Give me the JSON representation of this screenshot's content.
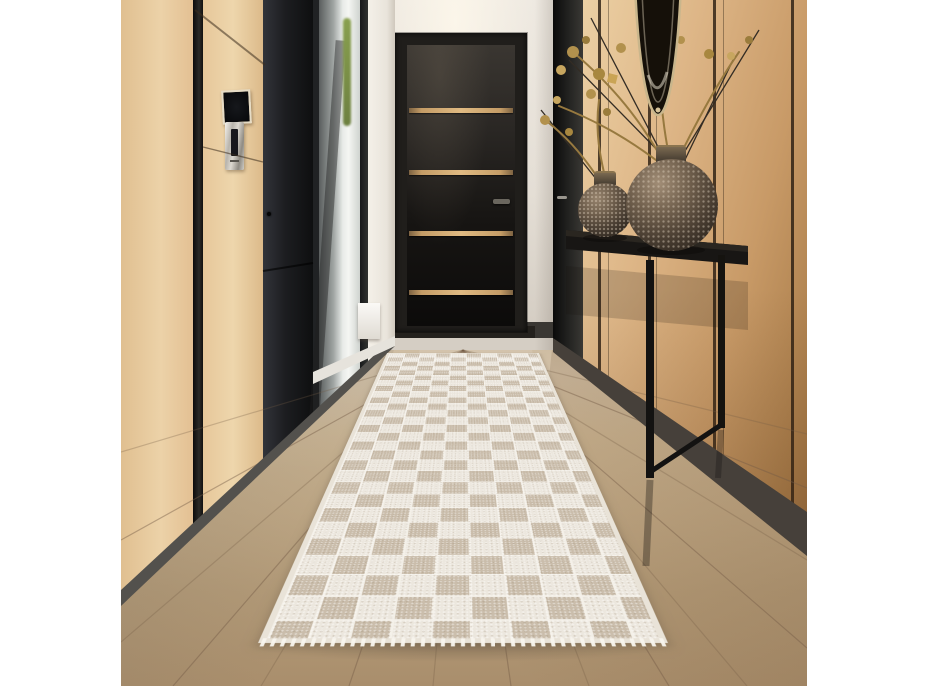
{
  "scene": {
    "type": "interior-photograph",
    "description": "Modern hallway interior: light oak wall paneling with black reveals, a black interior door with four gold inlay stripes, a glass side door, a slim black console table holding two hammered bronze sphere vases with dried gold botanicals beneath a black oval mirror, and an ivory checkerboard runner rug on a glossy light oak floor.",
    "objects": [
      {
        "label": "oak wall paneling"
      },
      {
        "label": "black interior door with gold inlay stripes"
      },
      {
        "label": "glass side door"
      },
      {
        "label": "wall-mounted access screen"
      },
      {
        "label": "metal restroom sign"
      },
      {
        "label": "black console table"
      },
      {
        "label": "hammered bronze sphere vase (small)"
      },
      {
        "label": "hammered bronze sphere vase (large)"
      },
      {
        "label": "dried gold floral arrangement"
      },
      {
        "label": "oval black-framed mirror"
      },
      {
        "label": "ivory checkerboard runner rug"
      },
      {
        "label": "glossy oak plank floor"
      }
    ],
    "rug": {
      "pattern": "checkerboard",
      "columns": 10,
      "rows": 28
    }
  },
  "colors": {
    "wood_light": "#ecd2a8",
    "wood_mid": "#ddb586",
    "wood_dark": "#a97c49",
    "floor_light": "#d3c1a7",
    "floor_dark": "#a98e6c",
    "rug_raised": "#ece7de",
    "rug_flat": "#cabdab",
    "rug_border": "#e9e3d8",
    "door_black": "#141210",
    "door_stripe": "#e0ba82",
    "wall_white": "#eee9e1",
    "accent_gold": "#b3924f",
    "vase_bronze": "#4a3e32",
    "table_black": "#181614"
  }
}
